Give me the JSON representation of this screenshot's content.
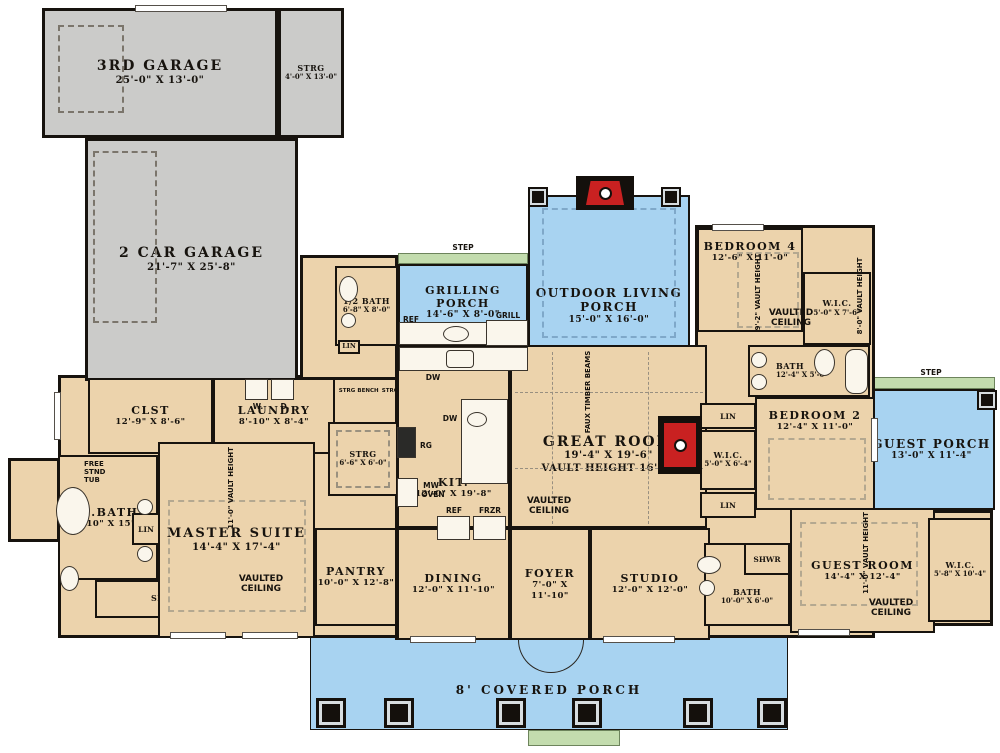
{
  "rooms": {
    "third_garage": {
      "label": "3RD GARAGE",
      "dims": "25'-0\" X 13'-0\""
    },
    "garage_strg": {
      "label": "STRG",
      "dims": "4'-0\" X 13'-0\""
    },
    "two_car_garage": {
      "label": "2 CAR GARAGE",
      "dims": "21'-7\" X 25'-8\""
    },
    "grilling_porch": {
      "label": "GRILLING PORCH",
      "dims": "14'-6\" X 8'-0\""
    },
    "outdoor_living_porch": {
      "label": "OUTDOOR LIVING PORCH",
      "dims": "15'-0\" X 16'-0\""
    },
    "guest_porch": {
      "label": "GUEST PORCH",
      "dims": "13'-0\" X 11'-4\""
    },
    "covered_porch": {
      "label": "8' COVERED PORCH"
    },
    "half_bath": {
      "label": "1/2 BATH",
      "dims": "6'-8\" X 8'-0\""
    },
    "laundry": {
      "label": "LAUNDRY",
      "dims": "8'-10\" X 8'-4\""
    },
    "clst": {
      "label": "CLST",
      "dims": "12'-9\" X 8'-6\""
    },
    "m_bath": {
      "label": "M.BATH",
      "dims": "10'-10\" X 15'-4\""
    },
    "master_suite": {
      "label": "MASTER SUITE",
      "dims": "14'-4\" X 17'-4\""
    },
    "pantry": {
      "label": "PANTRY",
      "dims": "10'-0\" X 12'-8\""
    },
    "strg_small": {
      "label": "STRG",
      "dims": "6'-6\" X 6'-0\""
    },
    "kitchen": {
      "label": "KIT.",
      "dims": "12'-0\" X 19'-8\""
    },
    "dining": {
      "label": "DINING",
      "dims": "12'-0\" X 11'-10\""
    },
    "foyer": {
      "label": "FOYER",
      "dims": "7'-0\" X 11'-10\""
    },
    "studio": {
      "label": "STUDIO",
      "dims": "12'-0\" X 12'-0\""
    },
    "great_room": {
      "label": "GREAT ROOM",
      "dims": "19'-4\" X 19'-6\"",
      "note": "VAULT HEIGHT 16'-6\""
    },
    "bedroom4": {
      "label": "BEDROOM 4",
      "dims": "12'-6\" X 11'-0\""
    },
    "wic_bed4": {
      "label": "W.I.C.",
      "dims": "5'-0\" X 7'-6\""
    },
    "bath_shared": {
      "label": "BATH",
      "dims": "12'-4\" X 5'-0\""
    },
    "bedroom2": {
      "label": "BEDROOM 2",
      "dims": "12'-4\" X 11'-0\""
    },
    "wic_bed2": {
      "label": "W.I.C.",
      "dims": "5'-0\" X 6'-4\""
    },
    "guest_room": {
      "label": "GUEST ROOM",
      "dims": "14'-4\" X 12'-4\""
    },
    "bath_guest": {
      "label": "BATH",
      "dims": "10'-0\" X 6'-0\""
    },
    "wic_guest": {
      "label": "W.I.C.",
      "dims": "5'-8\" X 10'-4\""
    }
  },
  "fixtures": {
    "step": "STEP",
    "ref": "REF",
    "grill": "GRILL",
    "dw": "DW",
    "rg": "RG",
    "mw": "MW",
    "oven": "OVEN",
    "frzr": "FRZR",
    "washer": "W.",
    "dryer": "D.",
    "lin": "LIN",
    "shwr": "SHWR",
    "free_stnd_tub": "FREE STND TUB",
    "bench": "BENCH",
    "strg": "STRG"
  },
  "annotations": {
    "vaulted_ceiling": "VAULTED CEILING",
    "faux_timber_beams": "FAUX TIMBER BEAMS",
    "vault_height_bed4": "9'-2\" VAULT HEIGHT",
    "vault_height_wic4": "8'-0\" VAULT HEIGHT",
    "vault_height_master": "11'-0\" VAULT HEIGHT",
    "vault_height_guest": "11'-0\" VAULT HEIGHT"
  },
  "colors": {
    "wall": "#17130e",
    "room_fill": "#ecd3ac",
    "garage_fill": "#cbcbc9",
    "porch_fill": "#a8d3f1",
    "step_fill": "#c3dcae",
    "fireplace": "#c92121"
  }
}
